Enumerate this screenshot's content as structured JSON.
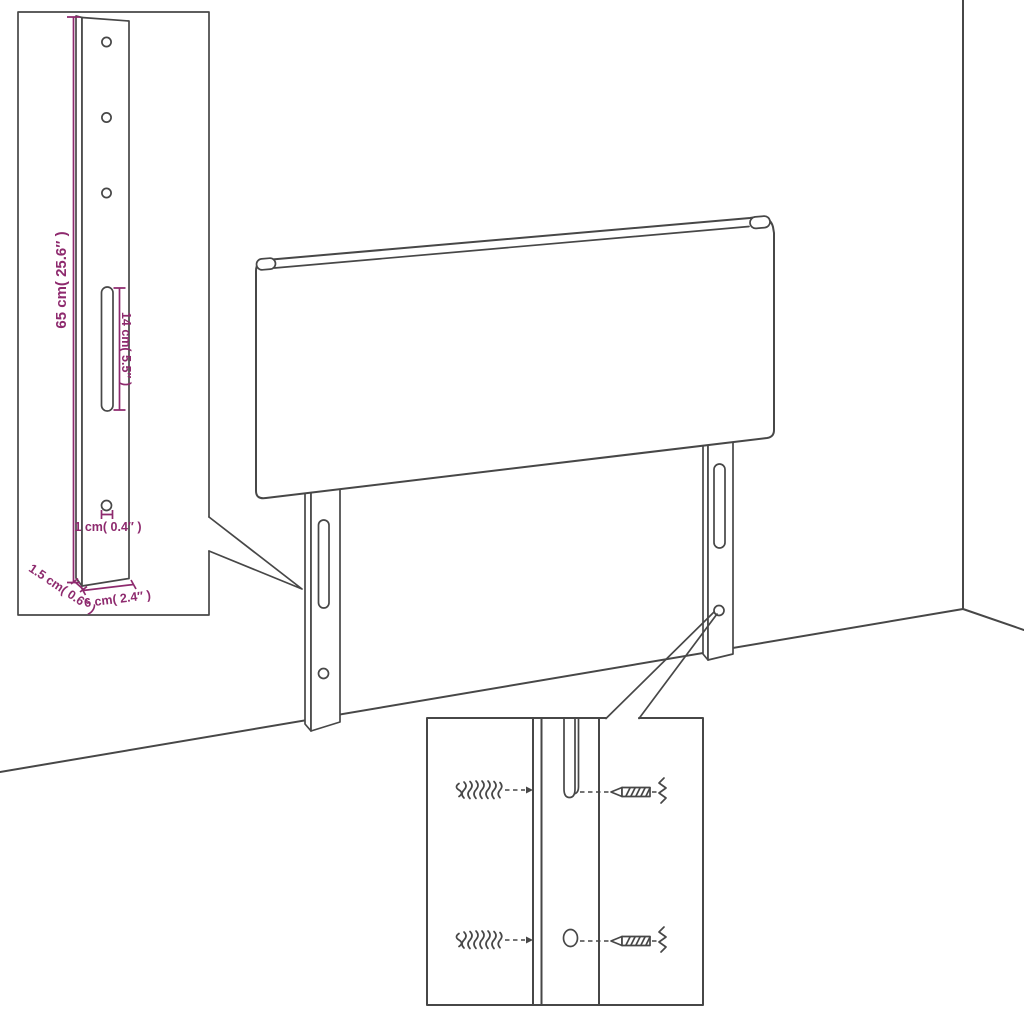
{
  "figure": {
    "description": "Line drawing of an upholstered headboard with two slotted mounting legs in a room corner, with a dimensioned zoom inset of one leg and a zoom inset of the wall-mounting hardware"
  },
  "colors": {
    "background": "#ffffff",
    "outline": "#474747",
    "dimension": "#8e2a6e"
  },
  "leg_inset": {
    "dim_height": "65 cm( 25.6″ )",
    "dim_slot": "14 cm( 5.5″ )",
    "dim_hole": "1 cm( 0.4″ )",
    "dim_depth": "1.5 cm( 0.6″ )",
    "dim_width": "6 cm( 2.4″ )"
  }
}
